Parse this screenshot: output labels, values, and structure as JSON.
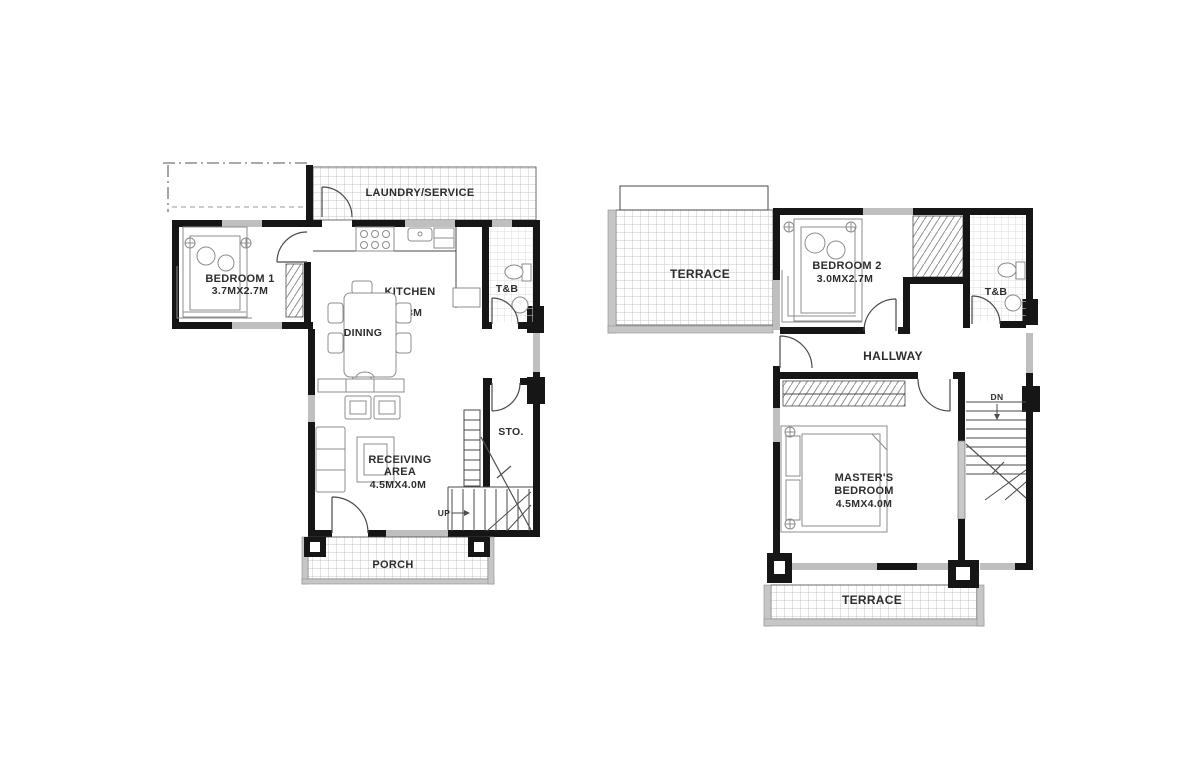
{
  "colors": {
    "wall": "#161616",
    "line": "#4a4a4a",
    "window": "#bfbfbf",
    "parapet": "#c6c6c6",
    "furn": "#8c8c8c",
    "text": "#2d2d2d",
    "bg": "#ffffff"
  },
  "ground_floor": {
    "laundry": {
      "label": "LAUNDRY/SERVICE"
    },
    "bedroom1": {
      "label": "BEDROOM 1",
      "dim": "3.7MX2.7M"
    },
    "kitchen": {
      "label": "KITCHEN",
      "dim": "4.5MX4.3M"
    },
    "dining": {
      "label": "DINING"
    },
    "tb": {
      "label": "T&B"
    },
    "sto": {
      "label": "STO."
    },
    "receiving": {
      "line1": "RECEIVING",
      "line2": "AREA",
      "dim": "4.5MX4.0M"
    },
    "porch": {
      "label": "PORCH"
    },
    "stairs": {
      "label": "UP"
    }
  },
  "second_floor": {
    "terrace_top": {
      "label": "TERRACE"
    },
    "bedroom2": {
      "label": "BEDROOM 2",
      "dim": "3.0MX2.7M"
    },
    "tb": {
      "label": "T&B"
    },
    "hallway": {
      "label": "HALLWAY"
    },
    "master": {
      "line1": "MASTER'S",
      "line2": "BEDROOM",
      "dim": "4.5MX4.0M"
    },
    "terrace_bottom": {
      "label": "TERRACE"
    },
    "stairs": {
      "label": "DN"
    }
  }
}
